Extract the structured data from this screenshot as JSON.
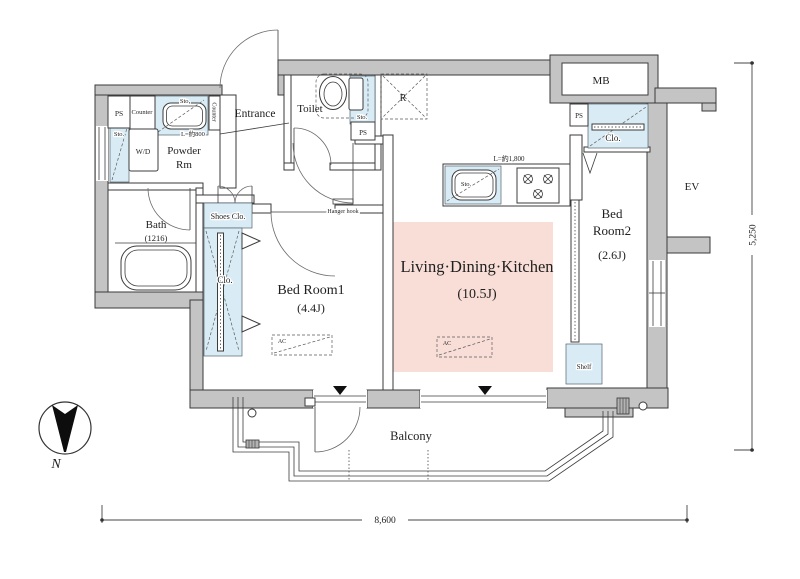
{
  "rooms": {
    "entrance": "Entrance",
    "toilet": "Toilet",
    "powder_line1": "Powder",
    "powder_line2": "Rm",
    "bath": "Bath",
    "bath_size": "(1216)",
    "ldk": "Living·Dining·Kitchen",
    "ldk_size": "(10.5J)",
    "bed1": "Bed Room1",
    "bed1_size": "(4.4J)",
    "bed2_line1": "Bed",
    "bed2_line2": "Room2",
    "bed2_size": "(2.6J)",
    "balcony": "Balcony"
  },
  "fixtures": {
    "ps": "PS",
    "mb": "MB",
    "ev": "EV",
    "fridge_space": "R",
    "washer_dryer": "W/D",
    "storage": "Sto.",
    "counter": "Counter",
    "closet": "Clo.",
    "shoes_closet": "Shoes Clo.",
    "shelf": "Shelf",
    "ac": "AC",
    "hanger_hook": "Hanger hook",
    "counter_length_powder": "L=約800",
    "counter_length_kitchen": "L=約1,800"
  },
  "dimensions": {
    "width_mm": "8,600",
    "height_mm": "5,250"
  },
  "compass": {
    "north": "N"
  },
  "colors": {
    "wall_fill": "#c4c4c4",
    "ldk_fill": "#f9ded7",
    "fixture_fill": "#d9ecf5",
    "line": "#3a3a3a"
  }
}
